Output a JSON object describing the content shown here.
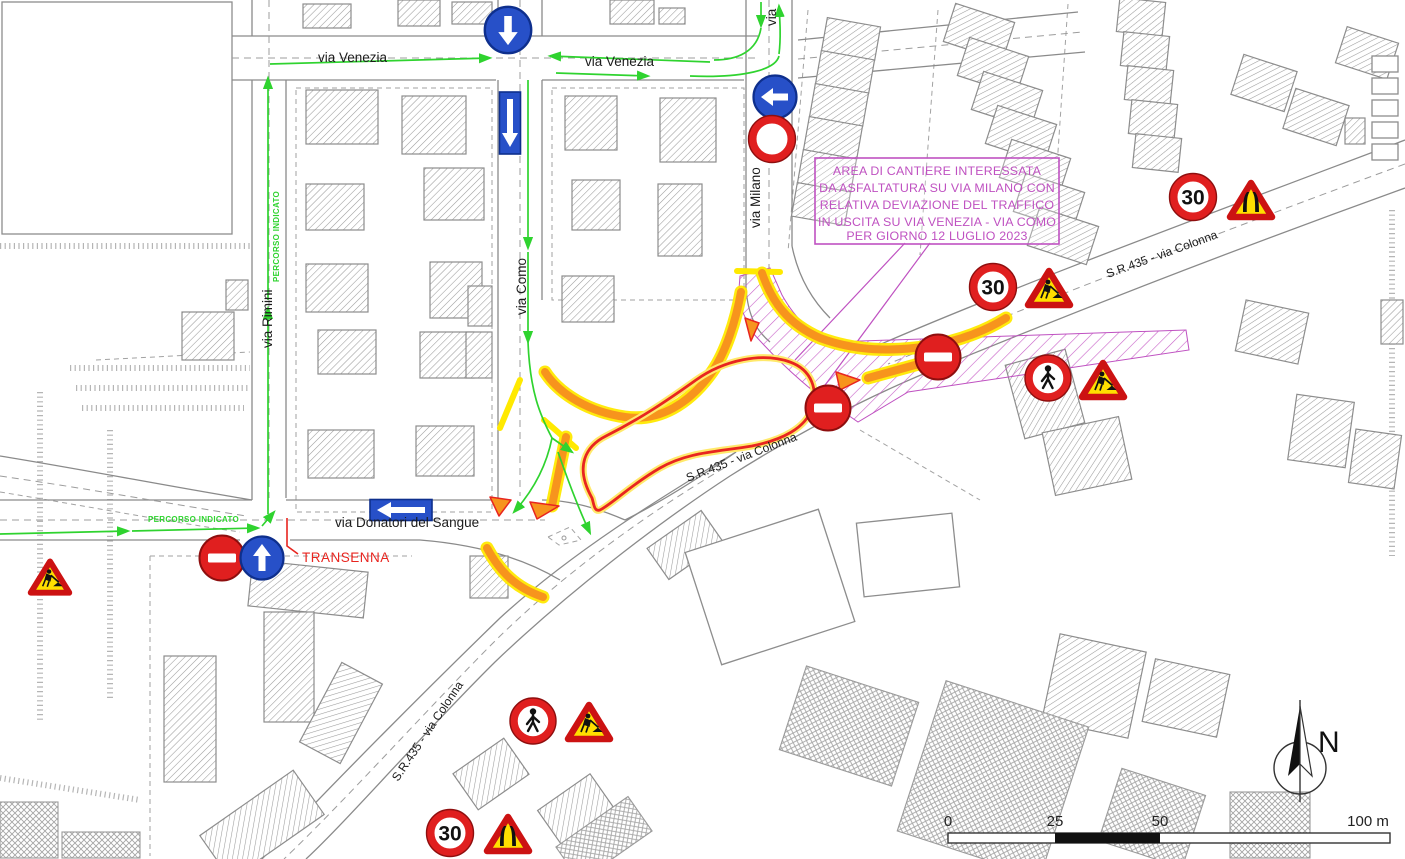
{
  "streets": {
    "via_venezia_w": "via Venezia",
    "via_venezia_e": "via Venezia",
    "via_rimini": "via Rimini",
    "via_como": "via Como",
    "via_milano": "via Milano",
    "via_milano_top_partial": "via",
    "via_donatori": "via Donatori del Sangue",
    "sr435_ne": "S.R.435 - via Colonna",
    "sr435_mid": "S.R.435 - via Colonna",
    "sr435_sw": "S.R.435 - via Colonna"
  },
  "detour": {
    "percorso_v": "PERCORSO INDICATO",
    "percorso_h": "PERCORSO INDICATO",
    "transenna": "TRANSENNA"
  },
  "annotation": {
    "line1": "AREA DI CANTIERE INTERESSATA",
    "line2": "DA ASFALTATURA SU VIA MILANO CON",
    "line3": "RELATIVA DEVIAZIONE DEL TRAFFICO",
    "line4": "IN USCITA SU VIA VENEZIA - VIA COMO",
    "line5": "PER GIORNO 12 LUGLIO 2023"
  },
  "signs": {
    "speed_limit": "30"
  },
  "scale_bar": {
    "t0": "0",
    "t25": "25",
    "t50": "50",
    "t100": "100 m"
  },
  "compass": {
    "label": "N"
  },
  "colors": {
    "detour_green": "#2fd32f",
    "works_orange": "#f7941d",
    "works_yellow": "#ffe900",
    "annotation_magenta": "#bf51c1",
    "sign_red": "#e01f1f",
    "sign_blue": "#2750c8",
    "closure_red": "#e8251f"
  }
}
